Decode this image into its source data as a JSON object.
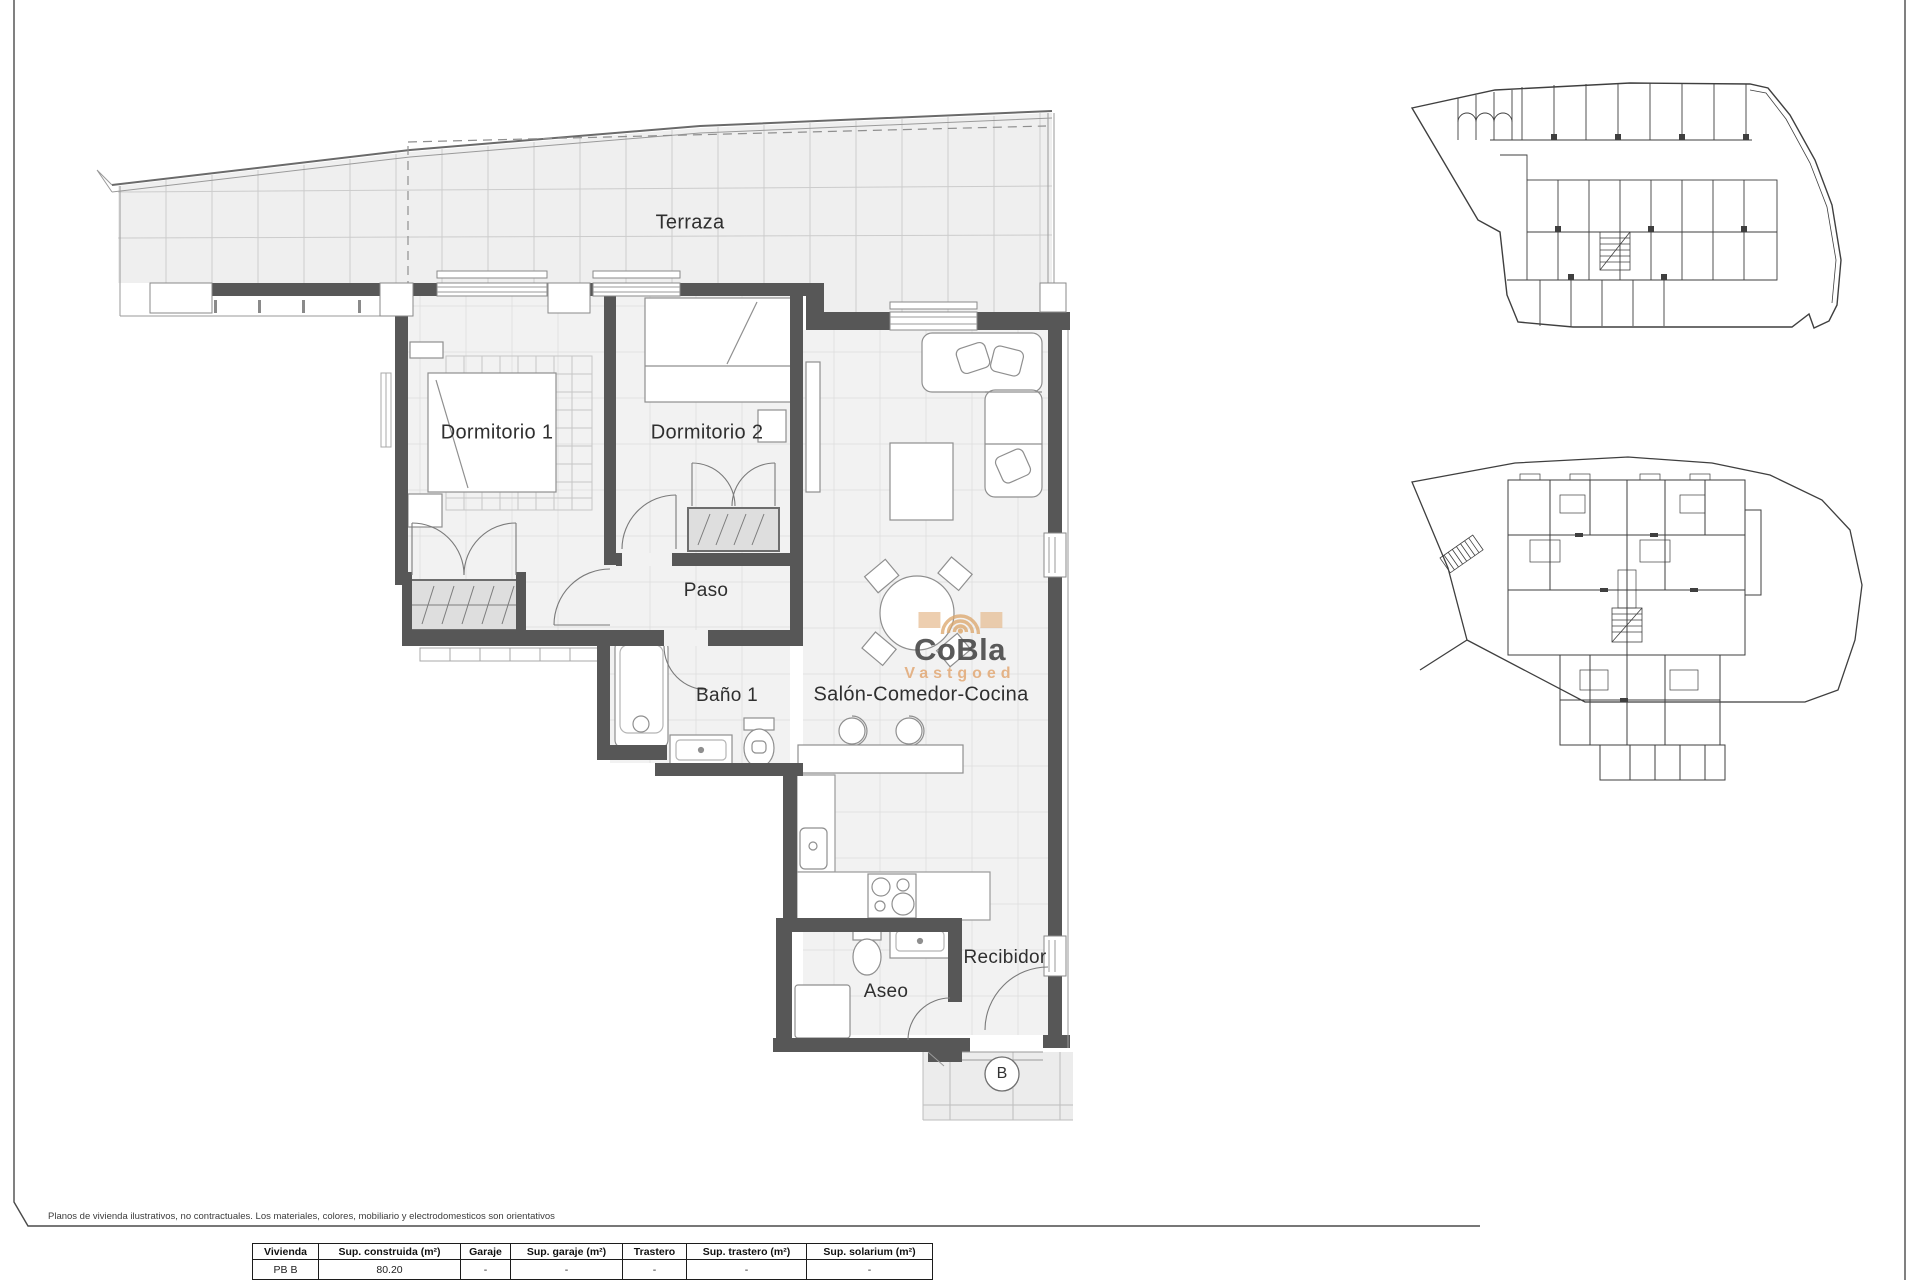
{
  "plan": {
    "rooms": [
      {
        "label": "Terraza"
      },
      {
        "label": "Dormitorio 1"
      },
      {
        "label": "Dormitorio 2"
      },
      {
        "label": "Paso"
      },
      {
        "label": "Baño 1"
      },
      {
        "label": "Salón-Comedor-Cocina"
      },
      {
        "label": "Aseo"
      },
      {
        "label": "Recibidor"
      }
    ],
    "unit_marker": "B",
    "wall_color": "#575757",
    "floor_color": "#f2f2f2"
  },
  "logo": {
    "name": "CoBla",
    "subtitle": "Vastgoed",
    "accent_color": "#E3AE7E",
    "text_color": "#4D4D4D"
  },
  "footer": {
    "disclaimer": "Planos de vivienda ilustrativos, no contractuales. Los materiales, colores, mobiliario y electrodomesticos son orientativos",
    "table": {
      "headers": [
        "Vivienda",
        "Sup. construida (m²)",
        "Garaje",
        "Sup. garaje (m²)",
        "Trastero",
        "Sup. trastero (m²)",
        "Sup. solarium (m²)"
      ],
      "rows": [
        [
          "PB B",
          "80.20",
          "-",
          "-",
          "-",
          "-",
          "-"
        ]
      ]
    }
  }
}
